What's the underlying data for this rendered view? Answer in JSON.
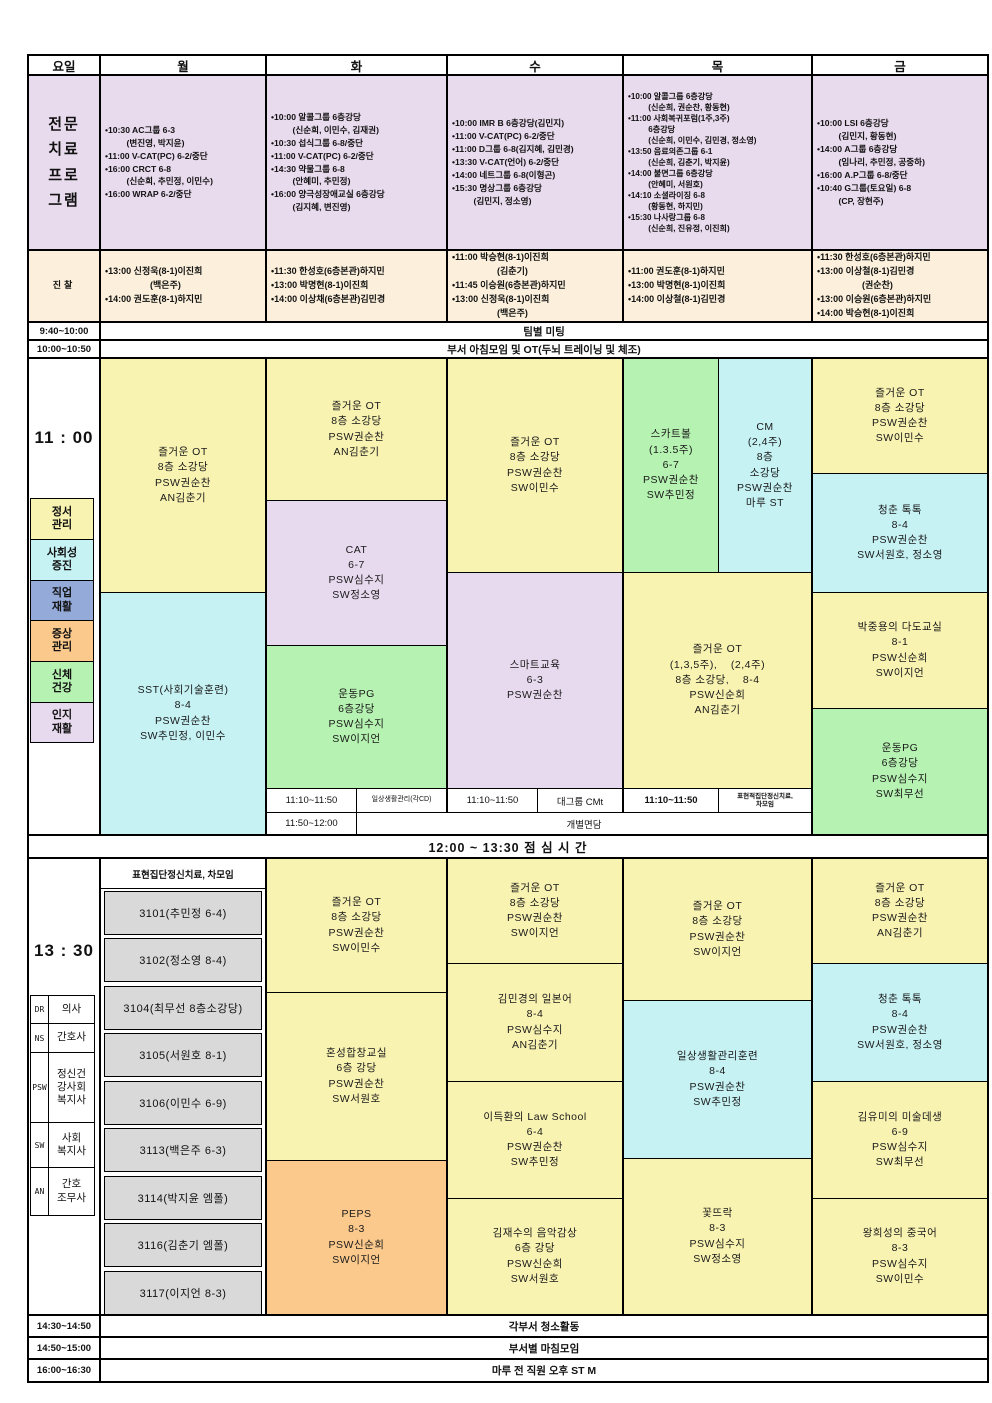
{
  "colors": {
    "header_lavender": "#E9DBEE",
    "cream": "#FCF0DC",
    "yellow": "#F9F3B2",
    "cyan": "#C6F2F4",
    "green": "#B6F2B1",
    "lavender": "#E8DAEE",
    "orange": "#FBC98C",
    "periwinkle": "#94ABD9",
    "grey": "#D9D9D9",
    "border": "#000000"
  },
  "header": {
    "days": [
      "요일",
      "월",
      "화",
      "수",
      "목",
      "금"
    ]
  },
  "program": {
    "label": "전문\n치료\n프로\n그램",
    "mon": "•10:30 AC그룹 6-3\n         (변진영, 박지윤)\n•11:00 V-CAT(PC) 6-2/중단\n•16:00 CRCT 6-8\n         (신순희, 추민정, 이민수)\n•16:00 WRAP 6-2/중단",
    "tue": "•10:00 알콜그룹 6층강당\n         (신순희, 이민수, 김재권)\n•10:30 섭식그룹 6-8/중단\n•11:00 V-CAT(PC) 6-2/중단\n•14:30 약물그룹 6-8\n         (안혜미, 추민정)\n•16:00 양극성장애교실 6층강당\n         (김지혜, 변진영)",
    "wed": "•10:00 IMR B 6층강당(김민지)\n•11:00 V-CAT(PC) 6-2/중단\n•11:00 D그룹 6-8(김지혜, 김민경)\n•13:30 V-CAT(언어) 6-2/중단\n•14:00 네트그룹 6-8(이형곤)\n•15:30 명상그룹 6층강당\n         (김민지, 정소영)",
    "thu": "•10:00 알콜그룹 6층강당\n         (신순희, 권순찬, 황동현)\n•11:00 사회복귀포럼(1주,3주)\n         6층강당\n         (신순희, 이민수, 김민경, 정소영)\n•13:50 음료의존그룹 6-1\n         (신순희, 김춘기, 박지윤)\n•14:00 불면그룹 6층강당\n         (안혜미, 서원호)\n•14:10 소셜라이징 6-8\n         (황동현, 하지민)\n•15:30 나사랑그룹 6-8\n         (신순희, 진유정, 이진희)",
    "fri": "•10:00 LSI 6층강당\n         (김민지, 황동현)\n•14:00 A그룹 6층강당\n         (임나리, 추민정, 공중하)\n•16:00 A.P그룹 6-8/중단\n•10:40 G그룹(토요일) 6-8\n         (CP, 장현주)"
  },
  "exam": {
    "label": "진찰",
    "mon": "•13:00 신정욱(8-1)이진희\n                  (백은주)\n•14:00 권도훈(8-1)하지민",
    "tue": "•11:30 한성호(6층본관)하지민\n•13:00 박명현(8-1)이진희\n•14:00 이상채(6층본관)김민경",
    "wed": "•11:00 박승현(8-1)이진희\n                  (김춘기)\n•11:45 이승원(6층본관)하지민\n•13:00 신정욱(8-1)이진희\n                  (백은주)",
    "thu": "•11:00 권도훈(8-1)하지민\n•13:00 박명현(8-1)이진희\n•14:00 이상철(8-1)김민경",
    "fri": "•11:30 한성호(6층본관)하지민\n•13:00 이상철(8-1)김민경\n                  (권순찬)\n•13:00 이승원(6층본관)하지민\n•14:00 박승현(8-1)이진희"
  },
  "rows": {
    "team": {
      "time": "9:40~10:00",
      "text": "팀별 미팅"
    },
    "morning": {
      "time": "10:00~10:50",
      "text": "부서 아침모임 및 OT(두뇌 트레이닝 및 체조)"
    }
  },
  "am": {
    "time": "11  :  00",
    "legend": [
      {
        "text": "정서\n관리"
      },
      {
        "text": "사회성\n증진"
      },
      {
        "text": "직업\n재활"
      },
      {
        "text": "증상\n관리"
      },
      {
        "text": "신체\n건강"
      },
      {
        "text": "인지\n재활"
      }
    ],
    "mon_top": "즐거운 OT\n8층 소강당\nPSW권순찬\nAN김춘기",
    "mon_bottom": "SST(사회기술훈련)\n8-4\nPSW권순찬\nSW추민정, 이민수",
    "tue_top": "즐거운 OT\n8층 소강당\nPSW권순찬\nAN김춘기",
    "tue_mid": "CAT\n6-7\nPSW심수지\nSW정소영",
    "tue_bottom": "운동PG\n6층강당\nPSW심수지\nSW이지언",
    "wed_top": "즐거운 OT\n8층 소강당\nPSW권순찬\nSW이민수",
    "wed_bottom": "스마트교육\n6-3\nPSW권순찬",
    "thu_left": "스카트볼\n(1.3.5주)\n6-7\nPSW권순찬\nSW추민정",
    "thu_right": "CM\n(2,4주)\n8층\n소강당\nPSW권순찬\n마루 ST",
    "thu_bottom": "즐거운 OT\n(1,3,5주),    (2,4주)\n8층 소강당,    8-4\nPSW신순희\nAN김춘기",
    "fri_1": "즐거운 OT\n8층 소강당\nPSW권순찬\nSW이민수",
    "fri_2": "청춘 톡톡\n8-4\nPSW권순찬\nSW서원호, 정소영",
    "fri_3": "박중용의 다도교실\n8-1\nPSW신순희\nSW이지언",
    "fri_4": "운동PG\n6층강당\nPSW심수지\nSW최무선",
    "sub1_tue_time": "11:10~11:50",
    "sub1_tue_label": "일상생활관리(각CD)",
    "sub1_wed_time": "11:10~11:50",
    "sub1_wed_label": "대그룹 CMt",
    "sub1_thu_time": "11:10~11:50",
    "sub1_thu_label": "표현적집단정신치료,\n차모임",
    "sub2_time": "11:50~12:00",
    "sub2_label": "개별면담"
  },
  "lunch": {
    "text": "12:00 ~ 13:30      점 심 시 간"
  },
  "pm": {
    "time": "13  :  30",
    "legend": [
      {
        "abbr": "DR",
        "label": "의사"
      },
      {
        "abbr": "NS",
        "label": "간호사"
      },
      {
        "abbr": "PSW",
        "label": "정신건\n강사회\n복지사"
      },
      {
        "abbr": "SW",
        "label": "사회\n복지사"
      },
      {
        "abbr": "AN",
        "label": "간호\n조무사"
      }
    ],
    "mon_head": "표현집단정신치료, 차모임",
    "mon_rooms": [
      "3101(추민정  6-4)",
      "3102(정소영  8-4)",
      "3104(최무선  8층소강당)",
      "3105(서원호  8-1)",
      "3106(이민수  6-9)",
      "3113(백은주  6-3)",
      "3114(박지윤  엠폴)",
      "3116(김춘기  엠폴)",
      "3117(이지언  8-3)"
    ],
    "tue_1": "즐거운 OT\n8층 소강당\nPSW권순찬\nSW이민수",
    "tue_2": "혼성합창교실\n6층 강당\nPSW권순찬\nSW서원호",
    "tue_3": "PEPS\n8-3\nPSW신순희\nSW이지언",
    "wed_1": "즐거운 OT\n8층 소강당\nPSW권순찬\nSW이지언",
    "wed_2": "김민경의 일본어\n8-4\nPSW심수지\nAN김춘기",
    "wed_3": "이득환의 Law School\n6-4\nPSW권순찬\nSW추민정",
    "wed_4": "김재수의 음악감상\n6층 강당\nPSW신순희\nSW서원호",
    "thu_1": "즐거운 OT\n8층 소강당\nPSW권순찬\nSW이지언",
    "thu_2": "일상생활관리훈련\n8-4\nPSW권순찬\nSW추민정",
    "thu_3": "꽃뜨락\n8-3\nPSW심수지\nSW정소영",
    "fri_1": "즐거운 OT\n8층 소강당\nPSW권순찬\nAN김춘기",
    "fri_2": "청춘 톡톡\n8-4\nPSW권순찬\nSW서원호, 정소영",
    "fri_3": "김유미의 미술데생\n6-9\nPSW심수지\nSW최무선",
    "fri_4": "왕희성의 중국어\n8-3\nPSW심수지\nSW이민수"
  },
  "footer": {
    "rows": [
      {
        "time": "14:30~14:50",
        "text": "각부서 청소활동"
      },
      {
        "time": "14:50~15:00",
        "text": "부서별 마침모임"
      },
      {
        "time": "16:00~16:30",
        "text": "마루 전 직원 오후 ST M"
      }
    ]
  }
}
